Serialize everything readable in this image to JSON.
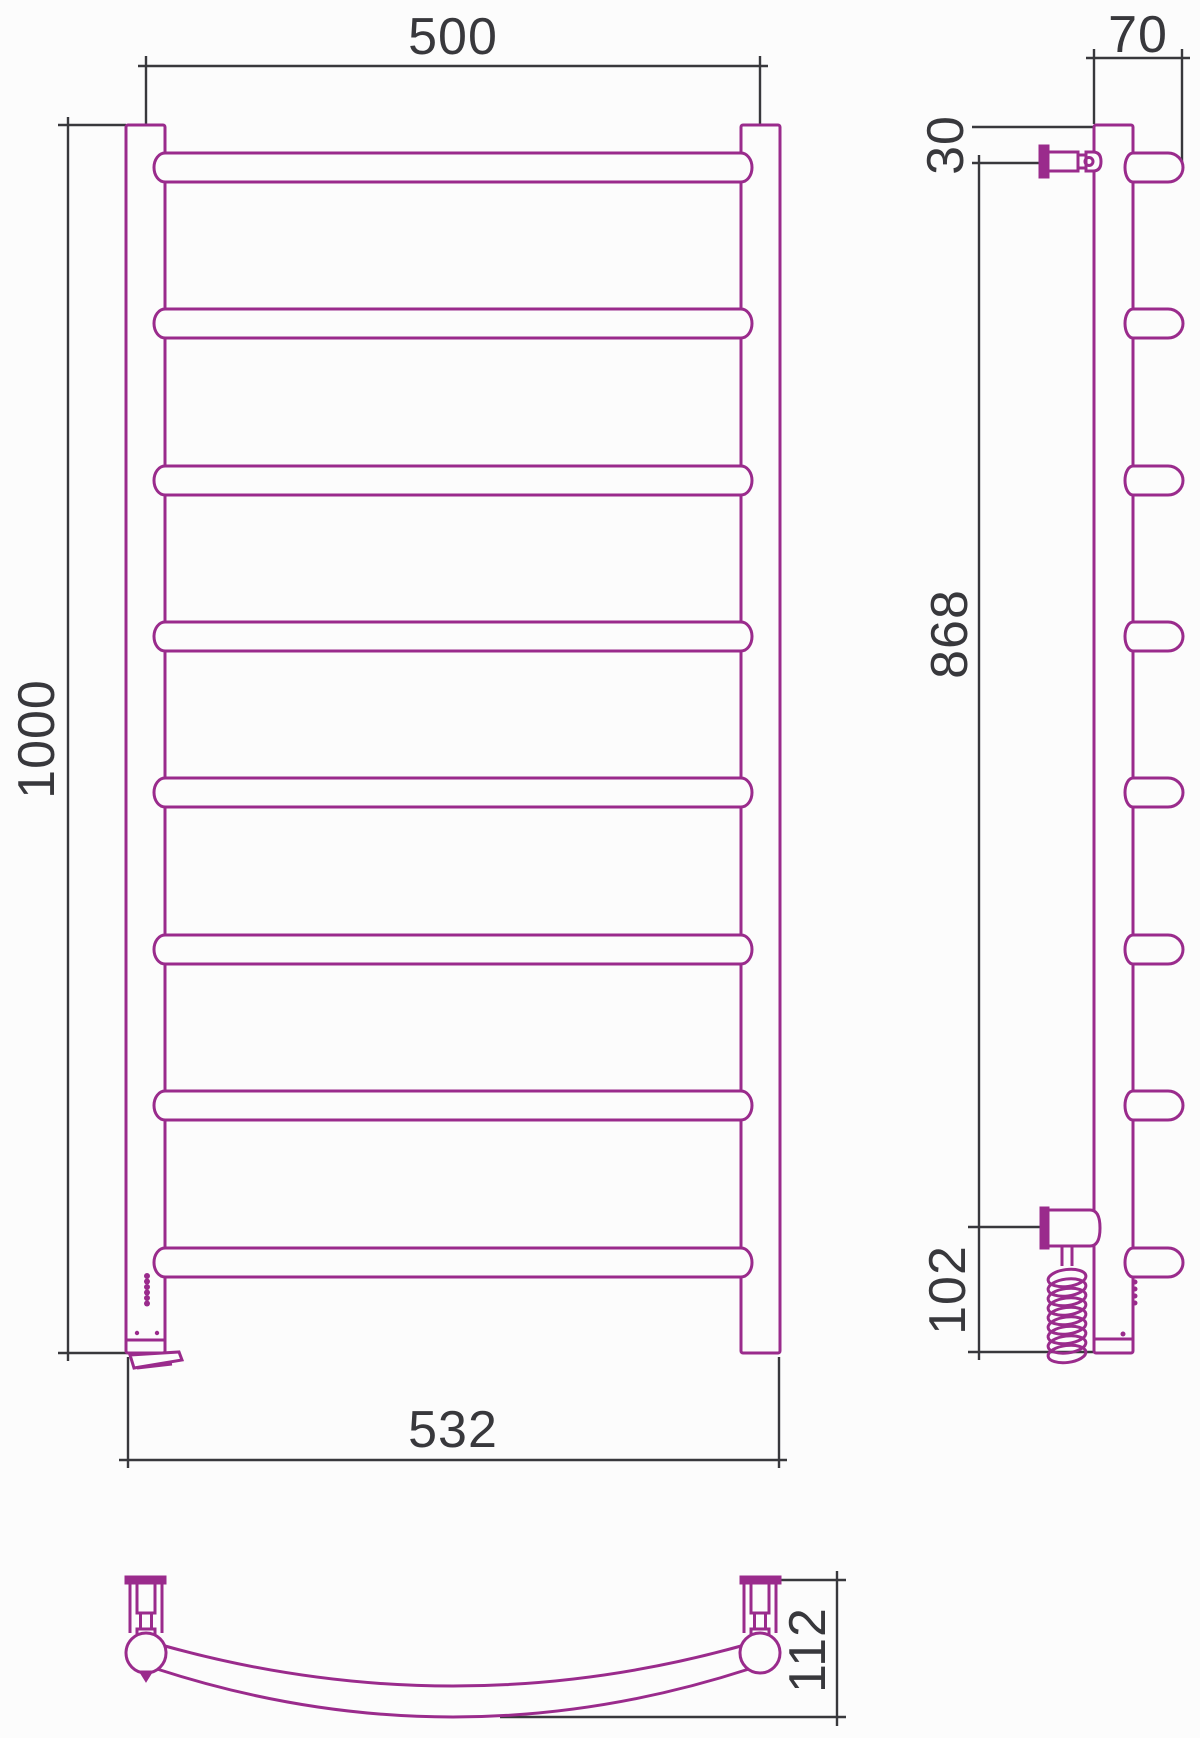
{
  "drawing": {
    "type": "technical-drawing",
    "subject": "ladder-towel-rail",
    "colors": {
      "outline": "#9a2b8c",
      "dimension": "#38383c",
      "background": "#fcfcfc"
    },
    "structure": {
      "rung_count": 8,
      "views": [
        "front",
        "side",
        "bottom"
      ]
    },
    "dimensions": {
      "front": {
        "axes_width": "500",
        "overall_height": "1000",
        "overall_width": "532"
      },
      "side": {
        "depth": "70",
        "top_offset": "30",
        "mount_span": "868",
        "bottom_offset": "102"
      },
      "bottom": {
        "wall_clearance": "112"
      }
    }
  }
}
